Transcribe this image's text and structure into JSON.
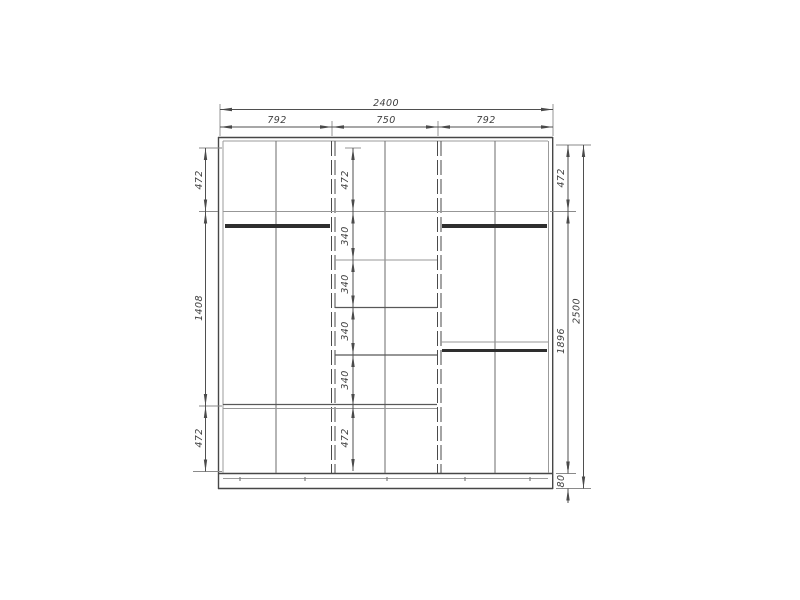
{
  "drawing": {
    "kind": "wardrobe-front-elevation-technical-drawing",
    "colors": {
      "background": "#ffffff",
      "frame_line": "#474747",
      "light_line": "#9b9b9b",
      "dimension_line": "#4f4f4f",
      "text": "#3e3e3e"
    },
    "dimensions": {
      "total_width": "2400",
      "section_widths": [
        "792",
        "750",
        "792"
      ],
      "left_chain": [
        "472",
        "1408",
        "472"
      ],
      "middle_chain": [
        "472",
        "340",
        "340",
        "340",
        "340",
        "472"
      ],
      "right_chain": [
        "472",
        "1896",
        "80"
      ],
      "total_height": "2500"
    }
  }
}
